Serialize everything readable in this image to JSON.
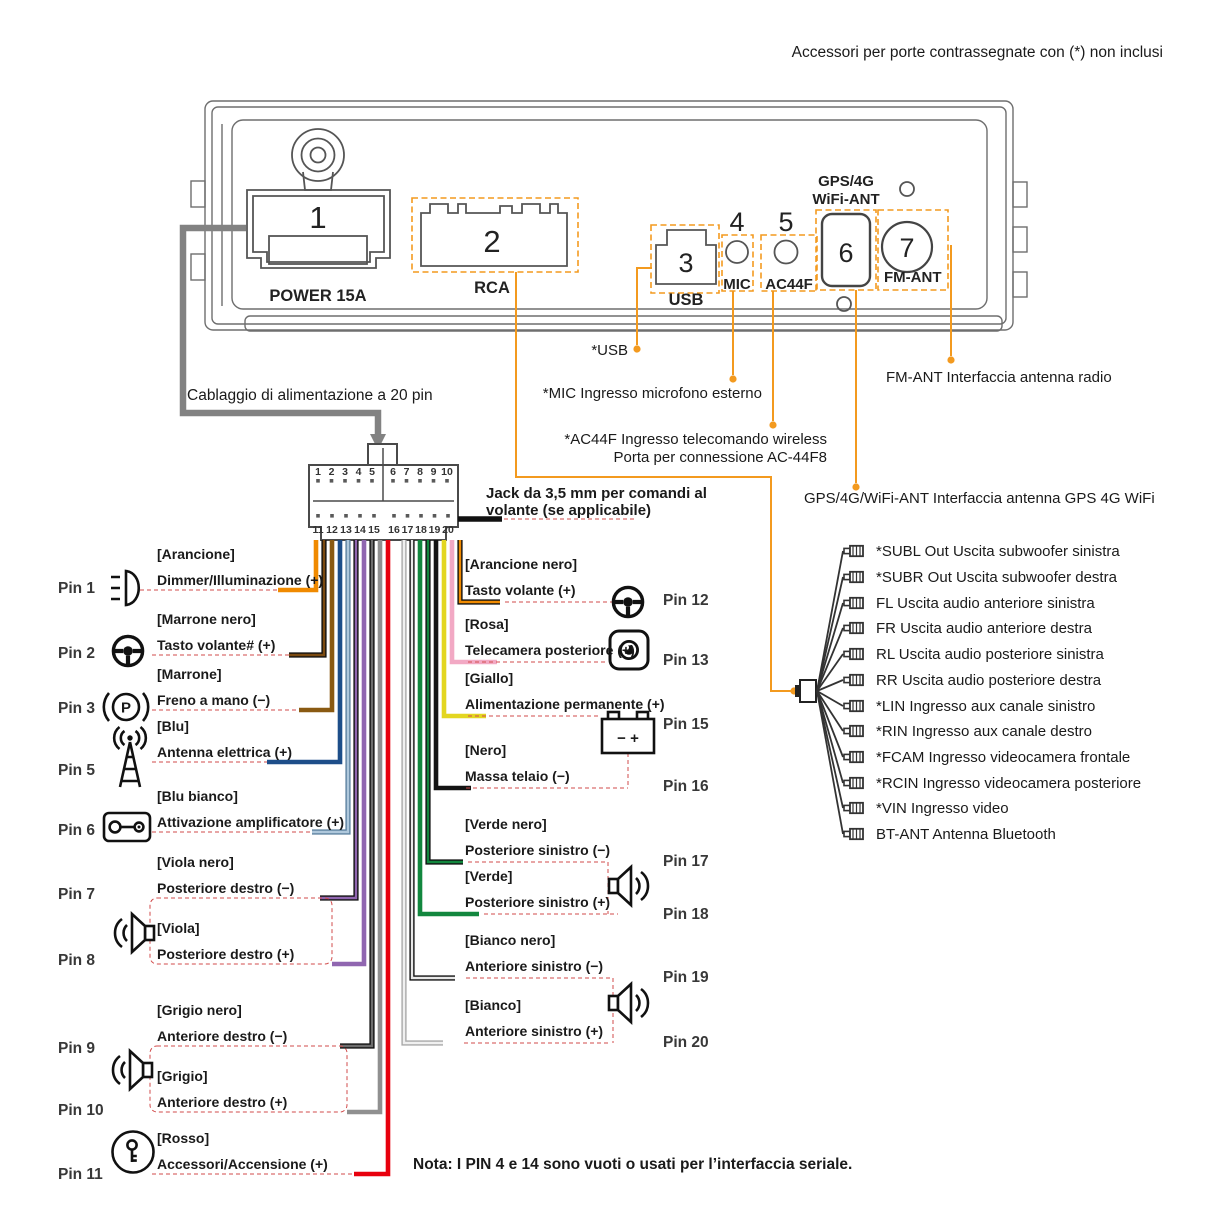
{
  "accent_colors": {
    "callout_orange": "#F39A1F",
    "dashed_red": "#D14B4B",
    "cable_gray": "#828282"
  },
  "top_note": "Accessori per porte contrassegnate con (*) non inclusi",
  "unit": {
    "ports": [
      {
        "num": "1",
        "label": "POWER 15A"
      },
      {
        "num": "2",
        "label": "RCA"
      },
      {
        "num": "3",
        "label": "USB"
      },
      {
        "num": "4",
        "label": "MIC"
      },
      {
        "num": "5",
        "label": "AC44F"
      },
      {
        "num": "6",
        "label_line1": "GPS/4G",
        "label_line2": "WiFi-ANT"
      },
      {
        "num": "7",
        "label": "FM-ANT"
      }
    ]
  },
  "callouts": {
    "power_harness": "Cablaggio di alimentazione a 20 pin",
    "usb": "*USB",
    "mic": "*MIC Ingresso microfono esterno",
    "ac44f_line1": "*AC44F Ingresso telecomando wireless",
    "ac44f_line2": "Porta per connessione AC-44F8",
    "fm_ant": "FM-ANT Interfaccia antenna radio",
    "gps_ant": "GPS/4G/WiFi-ANT Interfaccia antenna GPS 4G WiFi",
    "jack_line1": "Jack da 3,5 mm per comandi al",
    "jack_line2": "volante (se applicabile)"
  },
  "connector": {
    "top_pins": [
      "1",
      "2",
      "3",
      "4",
      "5",
      "6",
      "7",
      "8",
      "9",
      "10"
    ],
    "bottom_pins": [
      "11",
      "12",
      "13",
      "14",
      "15",
      "16",
      "17",
      "18",
      "19",
      "20"
    ]
  },
  "pins_left": [
    {
      "pin": "Pin 1",
      "color": "[Arancione]",
      "label": "Dimmer/Illuminazione (+)",
      "icon": "headlight-icon",
      "wire_color": "#F08A00"
    },
    {
      "pin": "Pin 2",
      "color": "[Marrone nero]",
      "label": "Tasto volante# (+)",
      "icon": "steering-wheel-icon",
      "wire_color": "#7B4A10",
      "stripe_color": "#111111"
    },
    {
      "pin": "Pin 3",
      "color": "[Marrone]",
      "label": "Freno a mano (−)",
      "icon": "parking-brake-icon",
      "wire_color": "#8A5A12"
    },
    {
      "pin": "Pin 5",
      "color": "[Blu]",
      "label": "Antenna elettrica (+)",
      "icon": "antenna-icon",
      "wire_color": "#1D4E89"
    },
    {
      "pin": "Pin 6",
      "color": "[Blu bianco]",
      "label": "Attivazione amplificatore (+)",
      "icon": "amplifier-icon",
      "wire_color": "#AFC8DC",
      "stripe_color": "#5E82A0"
    },
    {
      "pin": "Pin 7",
      "color": "[Viola nero]",
      "label": "Posteriore destro (−)",
      "icon": "speaker-icon",
      "wire_color": "#9066B0",
      "stripe_color": "#111111"
    },
    {
      "pin": "Pin 8",
      "color": "[Viola]",
      "label": "Posteriore destro (+)",
      "icon": "speaker-icon",
      "wire_color": "#9066B0"
    },
    {
      "pin": "Pin 9",
      "color": "[Grigio nero]",
      "label": "Anteriore destro (−)",
      "icon": "speaker-icon",
      "wire_color": "#6E6E6E",
      "stripe_color": "#111111"
    },
    {
      "pin": "Pin 10",
      "color": "[Grigio]",
      "label": "Anteriore destro (+)",
      "icon": "speaker-icon",
      "wire_color": "#909090"
    },
    {
      "pin": "Pin 11",
      "color": "[Rosso]",
      "label": "Accessori/Accensione (+)",
      "icon": "ignition-key-icon",
      "wire_color": "#E8000D"
    }
  ],
  "pins_right": [
    {
      "pin": "Pin 12",
      "color": "[Arancione nero]",
      "label": "Tasto volante (+)",
      "icon": "steering-wheel-icon",
      "wire_color": "#F08A00",
      "stripe_color": "#111111"
    },
    {
      "pin": "Pin 13",
      "color": "[Rosa]",
      "label": "Telecamera posteriore (+)",
      "icon": "rear-camera-icon",
      "wire_color": "#F2A9C4"
    },
    {
      "pin": "Pin 15",
      "color": "[Giallo]",
      "label": "Alimentazione permanente (+)",
      "icon": "battery-icon",
      "wire_color": "#E3D620"
    },
    {
      "pin": "Pin 16",
      "color": "[Nero]",
      "label": "Massa telaio (−)",
      "icon": "",
      "wire_color": "#141414"
    },
    {
      "pin": "Pin 17",
      "color": "[Verde nero]",
      "label": "Posteriore sinistro (−)",
      "icon": "speaker-icon",
      "wire_color": "#12873E",
      "stripe_color": "#111111"
    },
    {
      "pin": "Pin 18",
      "color": "[Verde]",
      "label": "Posteriore sinistro (+)",
      "icon": "speaker-icon",
      "wire_color": "#12873E"
    },
    {
      "pin": "Pin 19",
      "color": "[Bianco nero]",
      "label": "Anteriore sinistro (−)",
      "icon": "speaker-icon",
      "wire_color": "#E8E8E8",
      "stripe_color": "#111111"
    },
    {
      "pin": "Pin 20",
      "color": "[Bianco]",
      "label": "Anteriore sinistro (+)",
      "icon": "speaker-icon",
      "wire_color": "#F0F0F0",
      "stripe_color": "#A9A9A9"
    }
  ],
  "rca_outputs": [
    "*SUBL Out Uscita subwoofer sinistra",
    "*SUBR Out Uscita subwoofer destra",
    "FL Uscita audio anteriore sinistra",
    "FR Uscita audio anteriore destra",
    "RL Uscita audio posteriore sinistra",
    "RR Uscita audio posteriore destra",
    "*LIN Ingresso aux canale sinistro",
    "*RIN Ingresso aux canale destro",
    "*FCAM Ingresso videocamera frontale",
    "*RCIN Ingresso videocamera posteriore",
    "*VIN Ingresso video",
    "BT-ANT Antenna Bluetooth"
  ],
  "icon_glyphs": {
    "parking": "P",
    "battery": "− +"
  },
  "bottom_note": "Nota: I PIN 4 e 14 sono vuoti o usati per l’interfaccia seriale."
}
